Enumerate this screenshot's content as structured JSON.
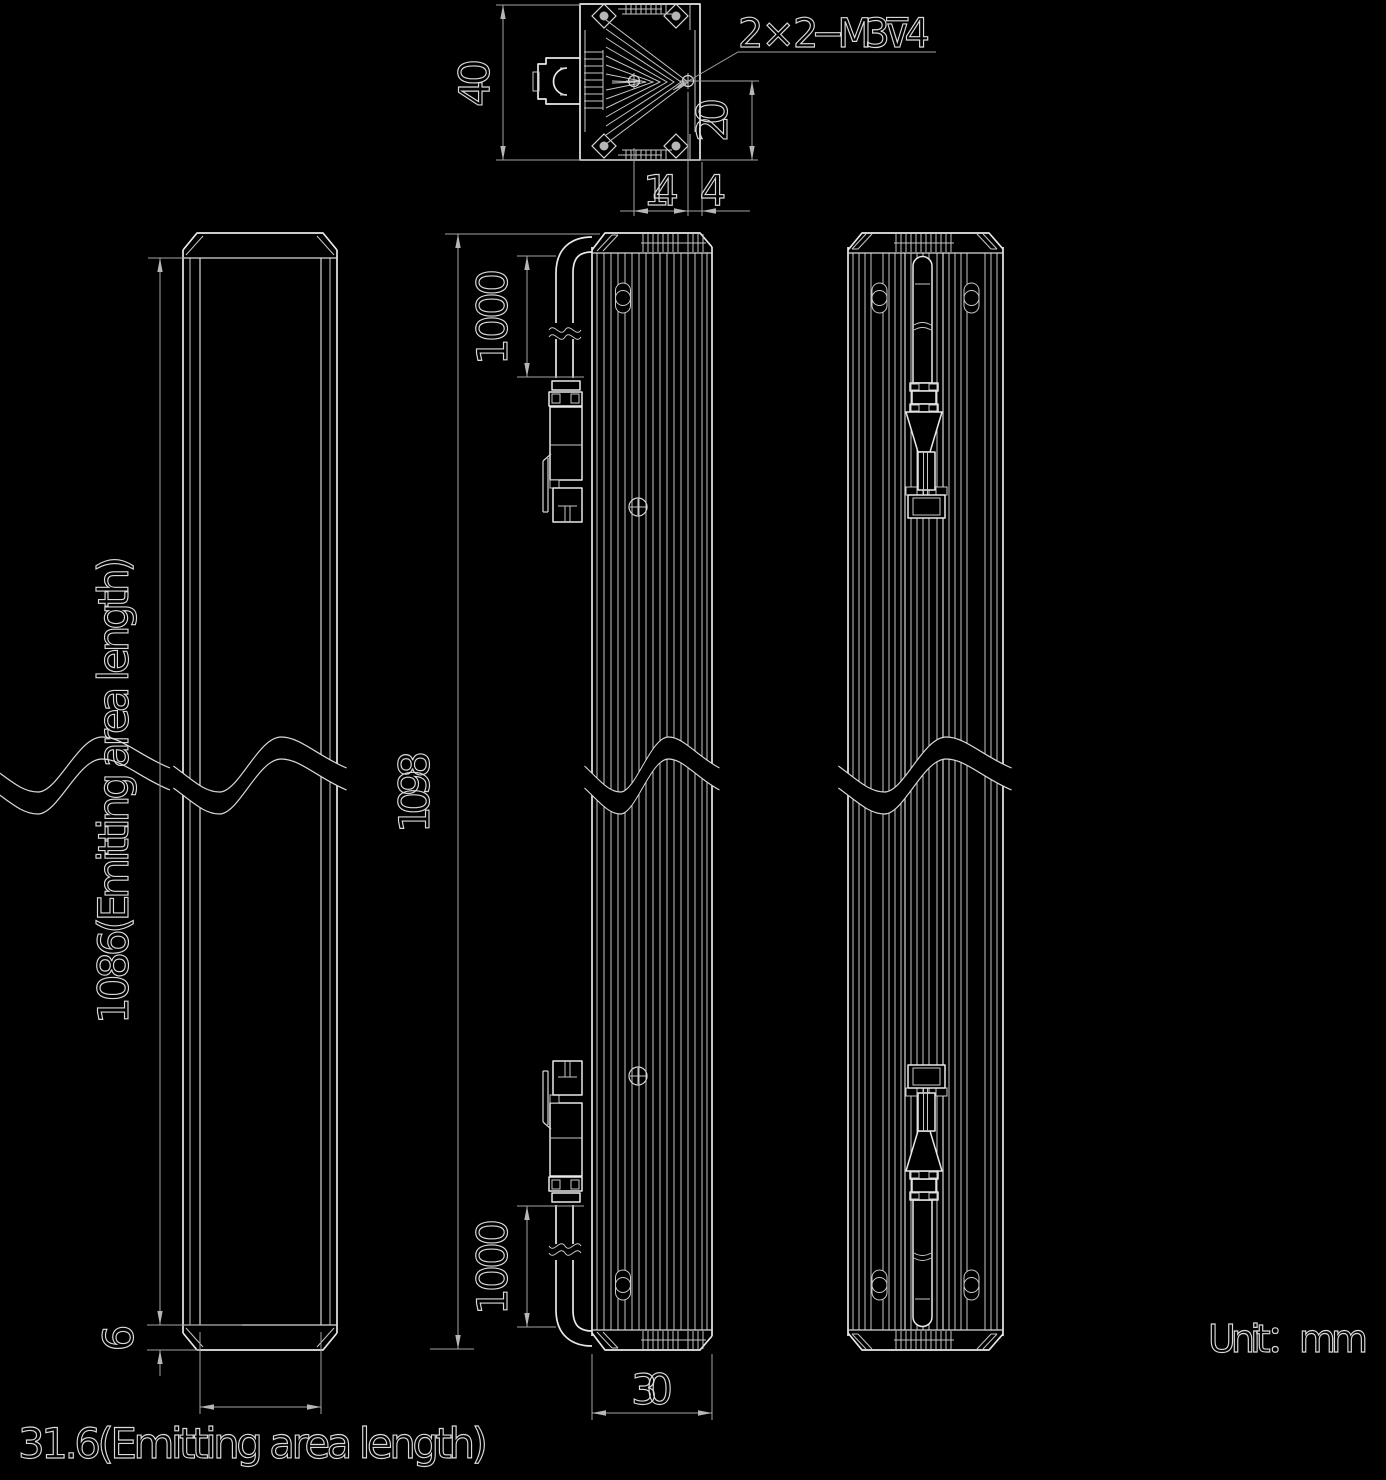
{
  "drawing": {
    "unit_label": "Unit：mm",
    "thread_note": "2 × 2−M3⊽4",
    "dims": {
      "section_height": "40",
      "hole_offset": "20",
      "hole_pitch": "14",
      "hole_edge": "4",
      "emitting_area_length": "1086(Emitting area length)",
      "bottom_margin": "6",
      "emitting_area_width": "31.6(Emitting area length)",
      "overall_length": "1098",
      "cable_length_top": "1000",
      "cable_length_bottom": "1000",
      "body_width": "30"
    },
    "colors": {
      "background": "#000000",
      "line": "#e9e9e9",
      "dim_line": "#9fa3a6",
      "text": "#d8dadc"
    }
  }
}
